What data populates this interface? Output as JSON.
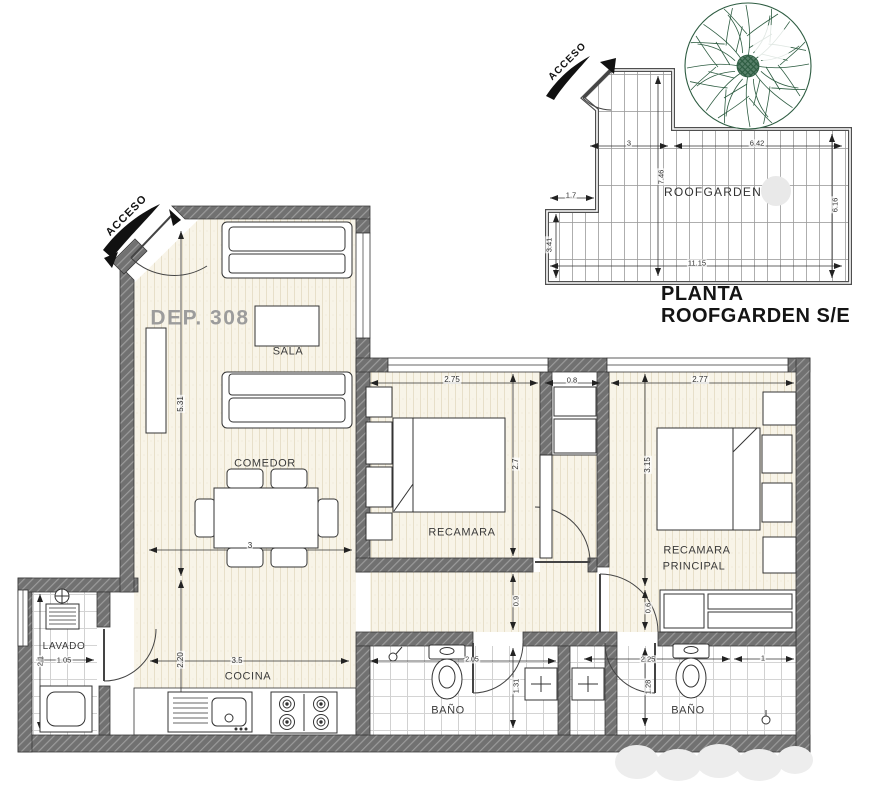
{
  "plan": {
    "unit_label": "DEP. 308",
    "access_label_main": "ACCESO",
    "access_label_roof": "ACCESO",
    "rooms": {
      "sala": "SALA",
      "comedor": "COMEDOR",
      "cocina": "COCINA",
      "lavado": "LAVADO",
      "recamara": "RECAMARA",
      "recamara_principal_1": "RECAMARA",
      "recamara_principal_2": "PRINCIPAL",
      "bano_1": "BAÑO",
      "bano_2": "BAÑO",
      "roofgarden": "ROOFGARDEN"
    },
    "dims_main": {
      "sala_h": "5.31",
      "cocina_h": "2.20",
      "comedor_w": "3",
      "cocina_w": "3.5",
      "lavado_w": "1.05",
      "lavado_h": "2.1",
      "recamara_w": "2.75",
      "closet_w": "0.8",
      "principal_w": "2.77",
      "recamara_h": "2.7",
      "principal_h": "3.15",
      "hall_w": "0.9",
      "closet_d": "0.6",
      "bano1_w": "2.05",
      "bano1_h": "1.31",
      "bano2_w1": "2.25",
      "bano2_w2": "1",
      "bano2_h": "1.28"
    },
    "dims_roof": {
      "top_left_w": "3",
      "top_right_w": "6.42",
      "left_h": "7.46",
      "notch_w": "1.7",
      "notch_h": "3.41",
      "bottom_w": "11.15",
      "right_h": "6.16"
    },
    "title": {
      "line1": "PLANTA",
      "line2": "ROOFGARDEN S/E"
    },
    "colors": {
      "wall": "#6f6f6f",
      "floor_wood": "#f8f4e8",
      "tile_line": "#c6c6c6",
      "tree_green": "#2d5c41",
      "dim_text": "#2e2e2e",
      "unit_label_gray": "#9c9c9c"
    }
  }
}
